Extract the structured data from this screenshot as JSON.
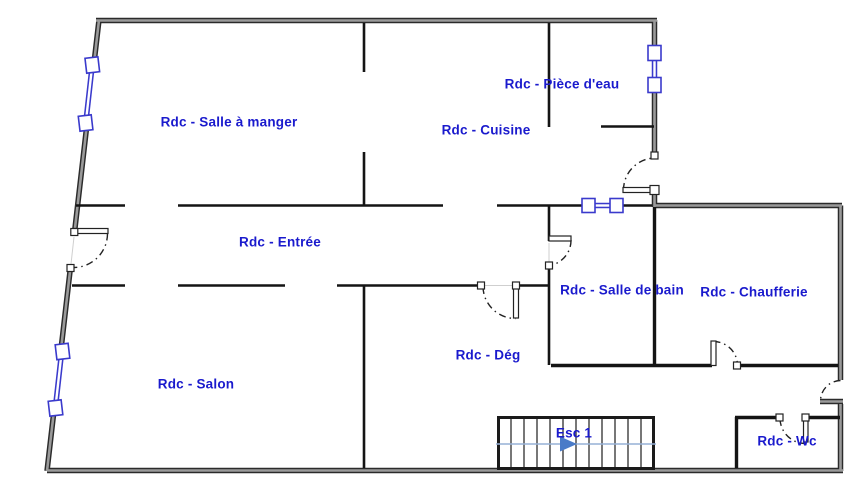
{
  "plan": {
    "floor_code": "Rdc",
    "type": "floor-plan"
  },
  "rooms": [
    {
      "id": "salle-a-manger",
      "label": "Rdc - Salle à manger"
    },
    {
      "id": "piece-d-eau",
      "label": "Rdc - Pièce d'eau"
    },
    {
      "id": "cuisine",
      "label": "Rdc - Cuisine"
    },
    {
      "id": "entree",
      "label": "Rdc - Entrée"
    },
    {
      "id": "salle-de-bain",
      "label": "Rdc - Salle de bain"
    },
    {
      "id": "chaufferie",
      "label": "Rdc - Chaufferie"
    },
    {
      "id": "salon",
      "label": "Rdc - Salon"
    },
    {
      "id": "deg",
      "label": "Rdc - Dég"
    },
    {
      "id": "wc",
      "label": "Rdc - Wc"
    }
  ],
  "stairs": {
    "label": "Esc 1",
    "tread_count": 12,
    "arrow_direction": "right"
  },
  "symbols": {
    "window_count": 4,
    "door_count": 7
  },
  "colors": {
    "label_text": "#1a1acd",
    "exterior_wall_edge": "#2b2b2b",
    "exterior_wall_fill": "#9a9a9a",
    "interior_wall": "#141414",
    "window_frame": "#3a3acc",
    "door_arc": "#222222",
    "stair_arrow_line": "#96b0d6",
    "stair_arrow_head": "#4a7bc8"
  }
}
